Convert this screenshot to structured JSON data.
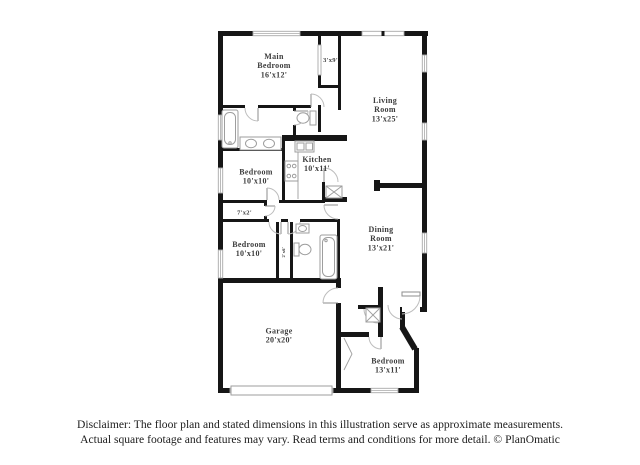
{
  "colors": {
    "wall": "#161616",
    "label": "#3d3d3d",
    "window": "#a9a9a9",
    "door_arc": "#bdbdbd",
    "fixture": "#9e9e9e",
    "background": "#ffffff"
  },
  "rooms": {
    "main_bedroom": {
      "name1": "Main",
      "name2": "Bedroom",
      "dims": "16'x12'"
    },
    "closet_3x9": {
      "dims": "3'x9'"
    },
    "living_room": {
      "name1": "Living",
      "name2": "Room",
      "dims": "13'x25'"
    },
    "bedroom_1": {
      "name1": "Bedroom",
      "dims": "10'x10'"
    },
    "kitchen": {
      "name1": "Kitchen",
      "dims": "10'x11'"
    },
    "closet_7x2": {
      "dims": "7'x2'"
    },
    "bedroom_2": {
      "name1": "Bedroom",
      "dims": "10'x10'"
    },
    "dining_room": {
      "name1": "Dining",
      "name2": "Room",
      "dims": "13'x21'"
    },
    "closet_2x6": {
      "dims": "2'x6'"
    },
    "garage": {
      "name1": "Garage",
      "dims": "20'x20'"
    },
    "bedroom_3": {
      "name1": "Bedroom",
      "dims": "13'x11'"
    }
  },
  "fixtures": [
    "bathtub-icon",
    "double-vanity-sink-icon",
    "toilet-icon",
    "kitchen-sink-icon",
    "stove-icon",
    "pantry-icon",
    "hall-sink-icon",
    "hall-toilet-icon",
    "hall-bathtub-icon",
    "water-heater-icon",
    "garage-door",
    "entry-door"
  ],
  "footer": {
    "line1": "Disclaimer: The floor plan and stated dimensions in this illustration serve as approximate measurements.",
    "line2": "Actual square footage and features may vary. Read terms and conditions for more detail. © PlanOmatic"
  }
}
